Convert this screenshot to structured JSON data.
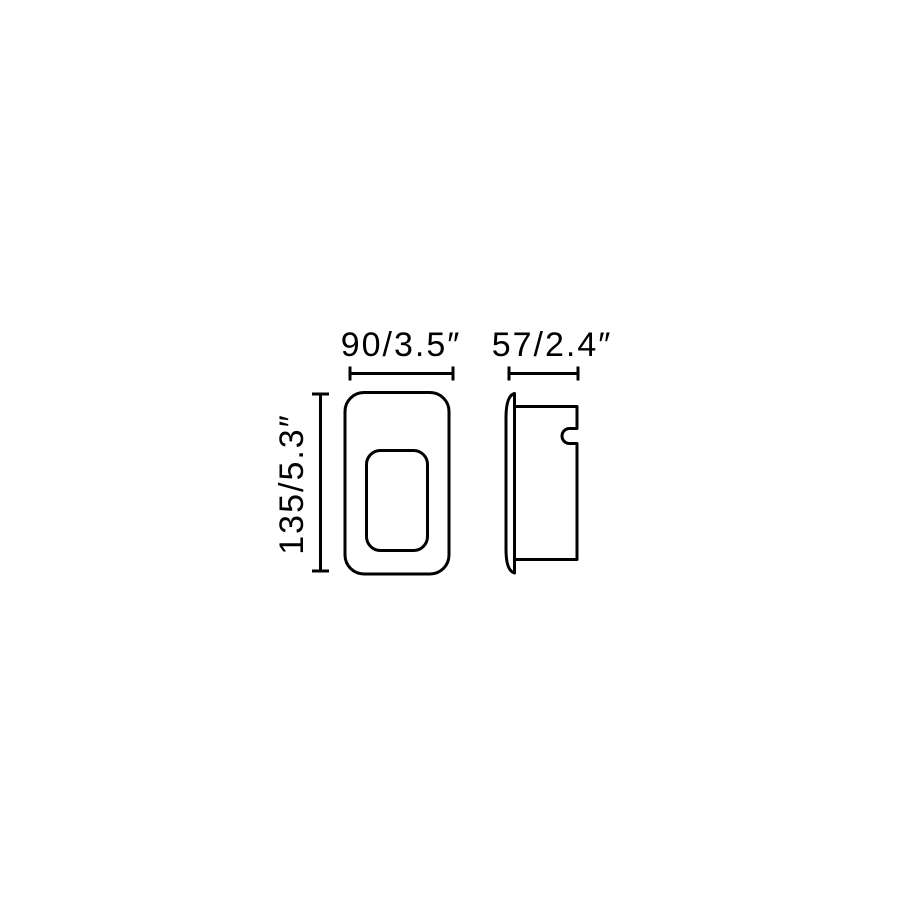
{
  "canvas": {
    "background": "#ffffff",
    "line_color": "#000000"
  },
  "drawing": {
    "labels": {
      "width": "90/3.5″",
      "depth": "57/2.4″",
      "height": "135/5.3″"
    },
    "values": {
      "width_mm": 90,
      "width_inches": 3.5,
      "depth_mm": 57,
      "depth_inches": 2.4,
      "height_mm": 135,
      "height_inches": 5.3
    }
  }
}
